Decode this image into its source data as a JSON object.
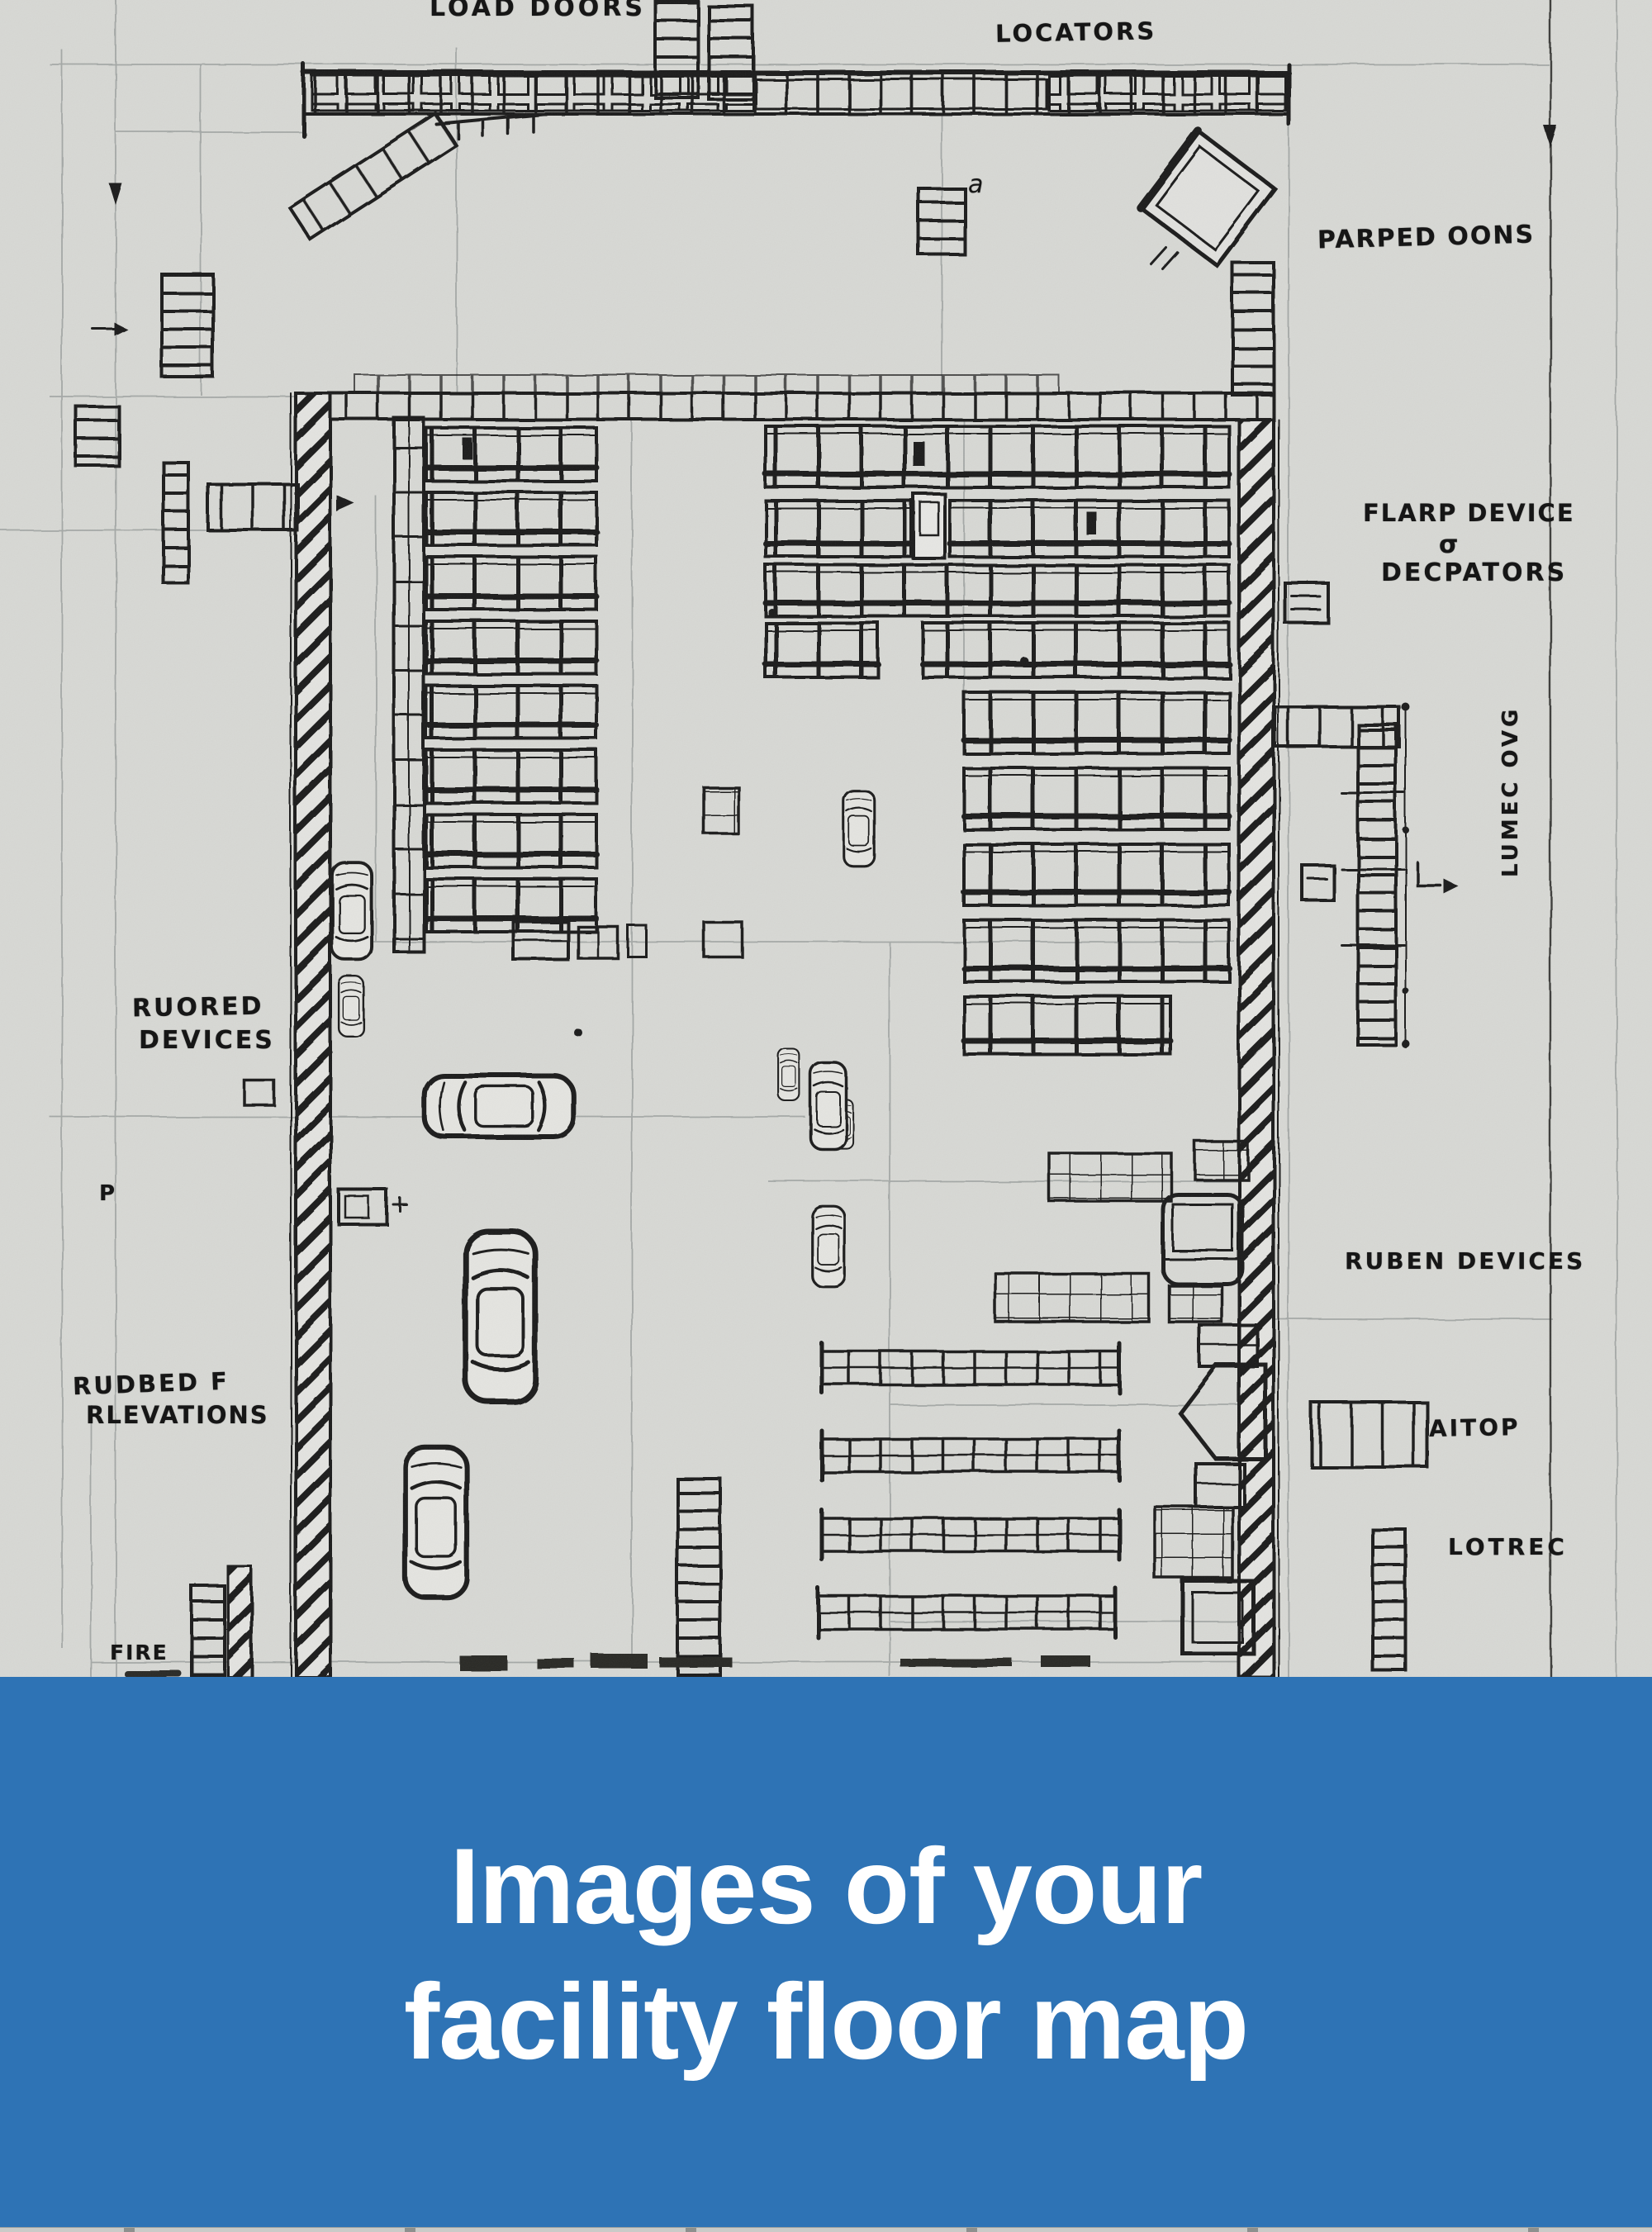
{
  "plan": {
    "paper_color": "#d7d8d4",
    "ink_color": "#1f1f1f",
    "labels": {
      "load_doors": "LOAD DOORS",
      "locators": "LOCATORS",
      "stray_a": "a",
      "parped_oons": "PARPED OONS",
      "flarp_line1": "FLARP DEVICE",
      "flarp_line2": "σ",
      "flarp_line3": "DECPATORS",
      "vertical_note": "LUMEC OVG",
      "ruored_line1": "RUORED",
      "ruored_line2": "DEVICES",
      "ruben_devices": "RUBEN DEVICES",
      "rudbed_line1": "RUDBED F",
      "rudbed_line2": "RLEVATIONS",
      "aitop": "AITOP",
      "lotrec": "LOTREC",
      "fire": "FIRE",
      "stray_p": "P"
    }
  },
  "banner": {
    "line1": "Images of your",
    "line2": "facility floor map",
    "background_color": "#2e73b5",
    "text_color": "#ffffff"
  }
}
